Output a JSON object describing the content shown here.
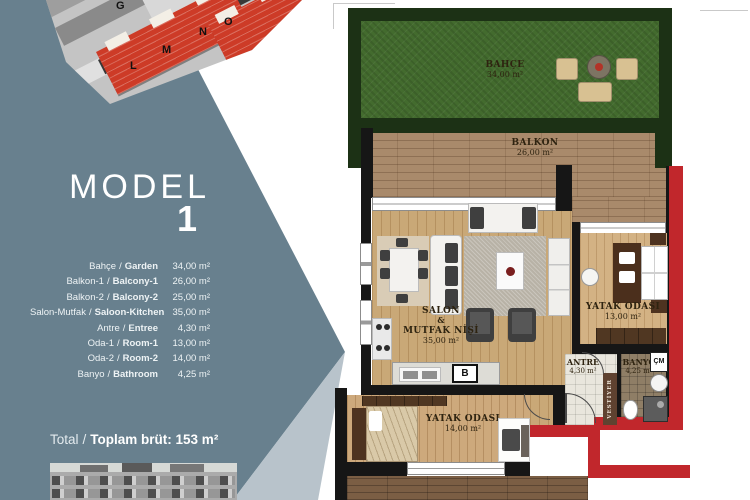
{
  "panel": {
    "model_label": "MODEL",
    "model_number": "1",
    "separator": "/",
    "rooms": [
      {
        "tr": "Bahçe",
        "en": "Garden",
        "area": "34,00 m²"
      },
      {
        "tr": "Balkon-1",
        "en": "Balcony-1",
        "area": "26,00 m²"
      },
      {
        "tr": "Balkon-2",
        "en": "Balcony-2",
        "area": "25,00 m²"
      },
      {
        "tr": "Salon-Mutfak",
        "en": "Saloon-Kitchen",
        "area": "35,00 m²"
      },
      {
        "tr": "Antre",
        "en": "Entree",
        "area": "4,30 m²"
      },
      {
        "tr": "Oda-1",
        "en": "Room-1",
        "area": "13,00 m²"
      },
      {
        "tr": "Oda-2",
        "en": "Room-2",
        "area": "14,00 m²"
      },
      {
        "tr": "Banyo",
        "en": "Bathroom",
        "area": "4,25 m²"
      }
    ],
    "total_label": "Total",
    "total_value": "Toplam brüt: 153 m²"
  },
  "site_plan": {
    "block_g": "G",
    "block_l": "L",
    "block_m": "M",
    "block_n": "N",
    "block_o": "O"
  },
  "plan": {
    "garden": {
      "name": "BAHÇE",
      "area": "34,00 m²"
    },
    "balcony": {
      "name": "BALKON",
      "area": "26,00 m²"
    },
    "salon": {
      "line1": "SALON",
      "line2": "&",
      "line3": "MUTFAK NİŞİ",
      "area": "35,00 m²"
    },
    "bedroom1": {
      "name": "YATAK ODASI",
      "area": "13,00 m²"
    },
    "bedroom2": {
      "name": "YATAK ODASI",
      "area": "14,00 m²"
    },
    "antre": {
      "name": "ANTRE",
      "area": "4,30 m²"
    },
    "banyo": {
      "name": "BANYO",
      "area": "4,25 m²"
    },
    "vestiyer_label": "VESTİYER",
    "washer_label": "ÇM",
    "b_label": "B"
  },
  "colors": {
    "panel_teal": "#68808E",
    "plan_wall_red": "#c1272c",
    "site_building_red": "#cd3b27",
    "grass_green": "#436b2e"
  }
}
